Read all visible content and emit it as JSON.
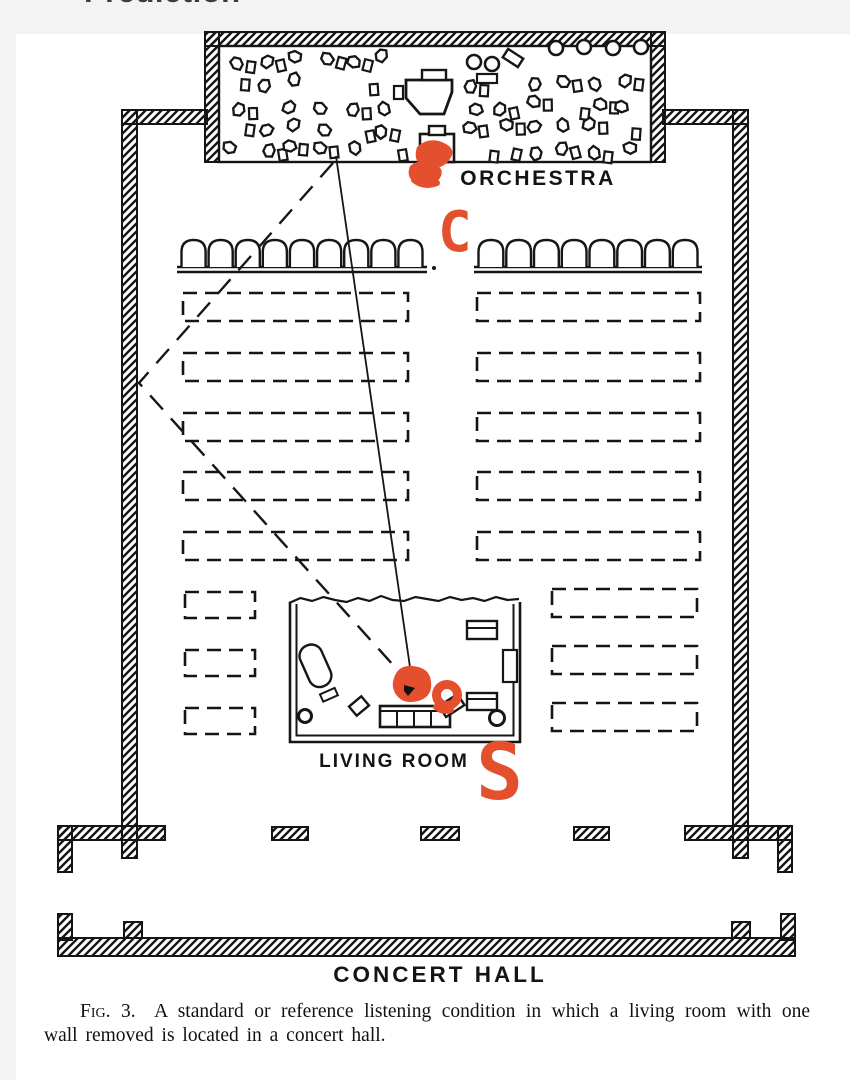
{
  "page": {
    "top_clipped_text": "Prediction"
  },
  "figure": {
    "labels": {
      "orchestra": "ORCHESTRA",
      "living_room": "LIVING ROOM",
      "concert_hall": "CONCERT HALL"
    },
    "annotations": {
      "conductor_mark": "C",
      "listener_mark": "S",
      "marker_color": "#e4502d"
    },
    "caption": {
      "prefix": "Fig. 3.",
      "body": "A standard or reference listening condition in which a living room with one wall removed is located in a concert hall."
    }
  }
}
